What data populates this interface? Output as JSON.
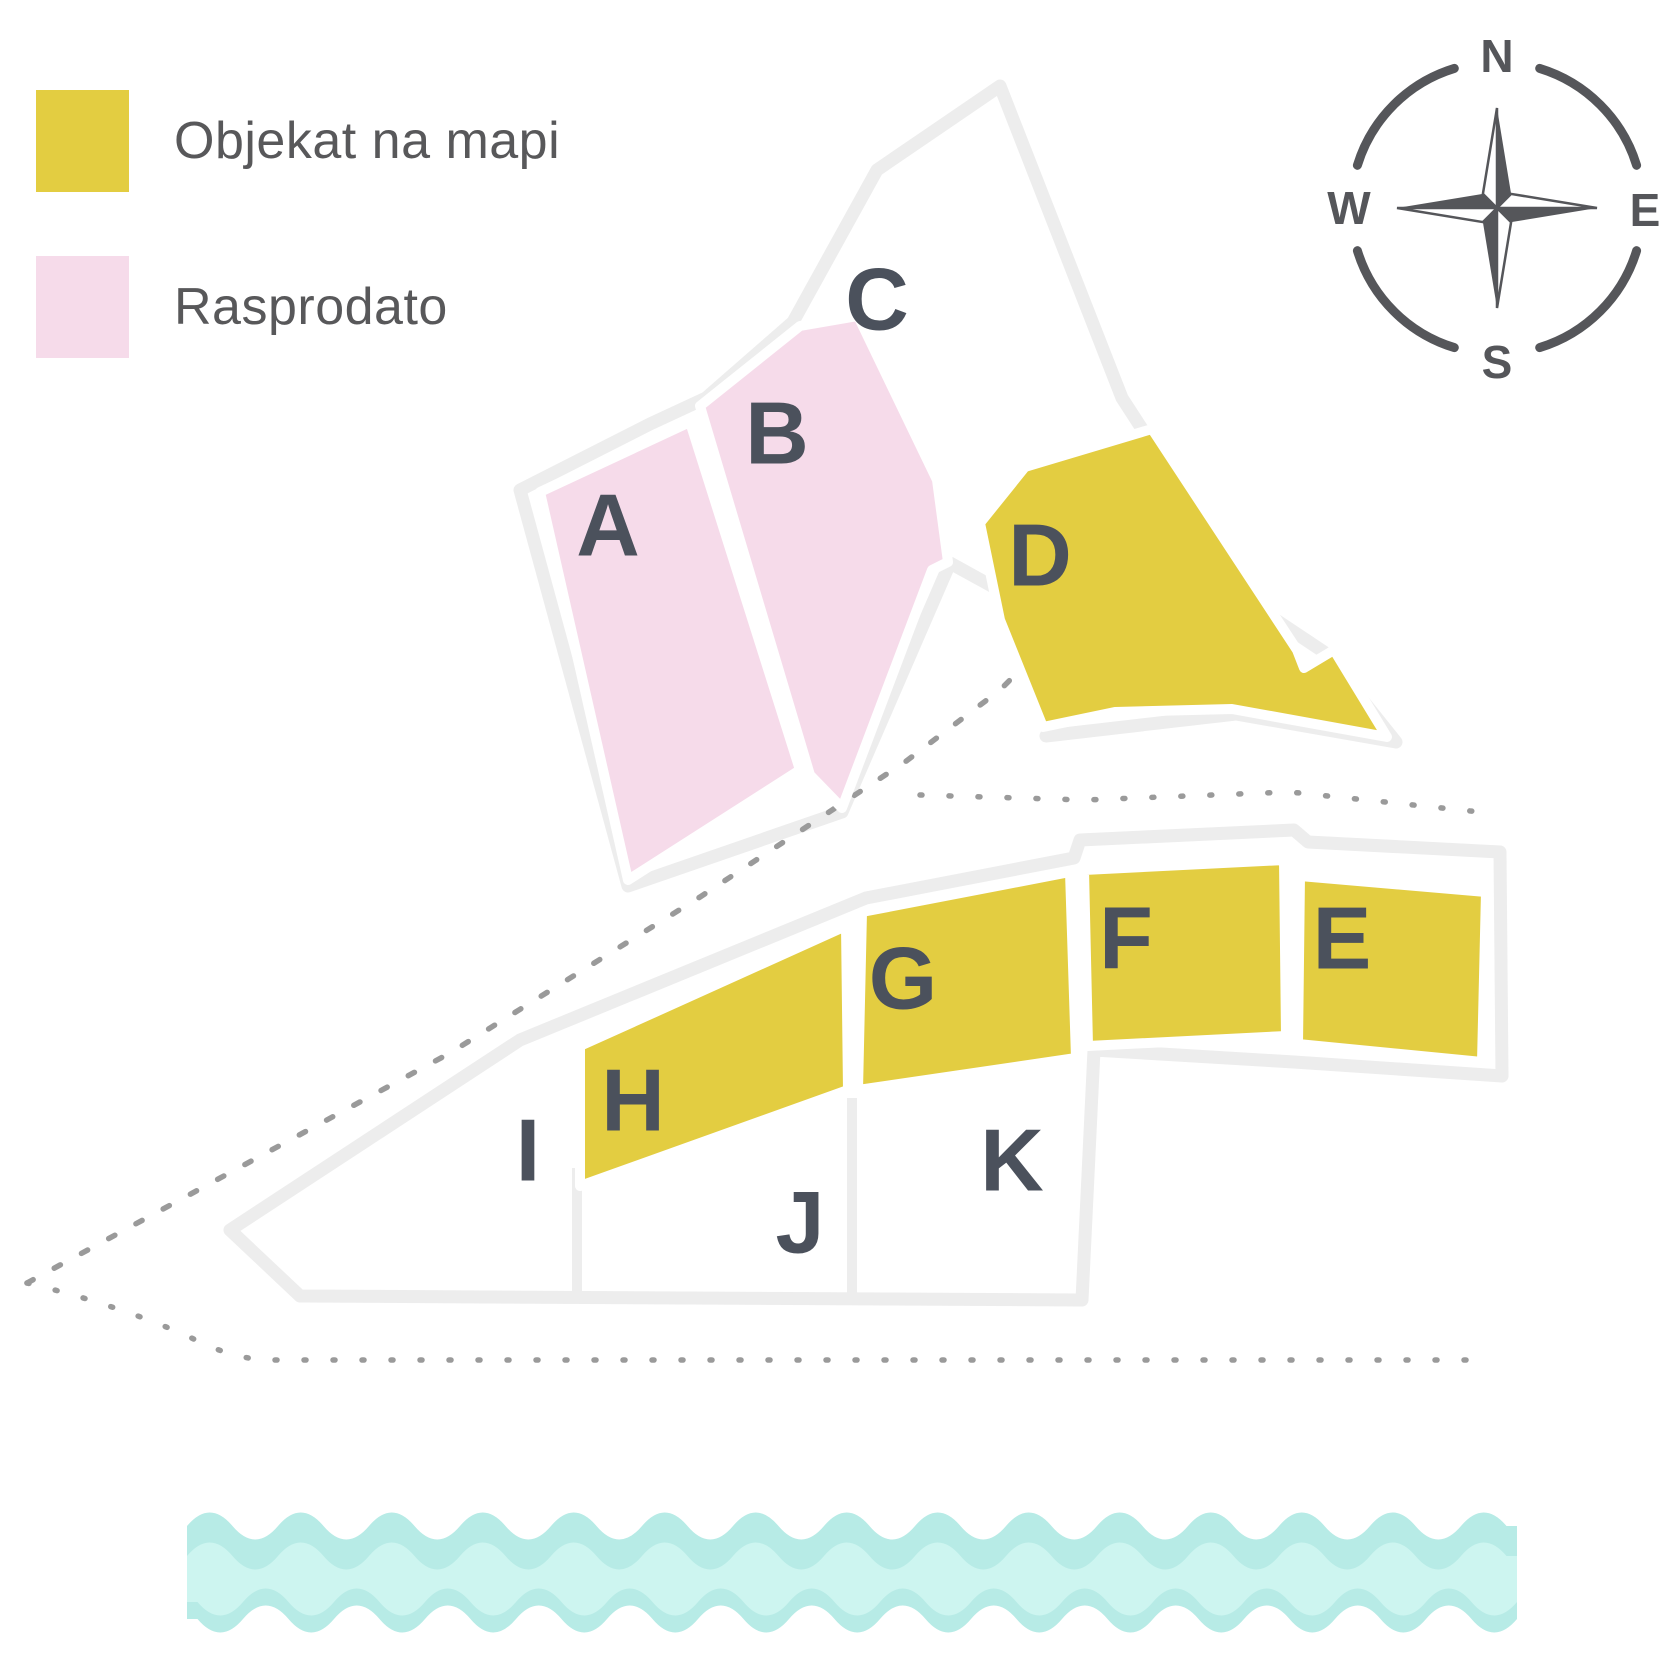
{
  "legend": {
    "items": [
      {
        "label": "Objekat na mapi",
        "status": "available",
        "color": "#e3cd41"
      },
      {
        "label": "Rasprodato",
        "status": "sold",
        "color": "#f6dbea"
      }
    ]
  },
  "zones": [
    {
      "label": "A",
      "status": "sold"
    },
    {
      "label": "B",
      "status": "sold"
    },
    {
      "label": "C",
      "status": "none"
    },
    {
      "label": "D",
      "status": "available"
    },
    {
      "label": "E",
      "status": "available"
    },
    {
      "label": "F",
      "status": "available"
    },
    {
      "label": "G",
      "status": "available"
    },
    {
      "label": "H",
      "status": "available"
    },
    {
      "label": "I",
      "status": "none"
    },
    {
      "label": "J",
      "status": "none"
    },
    {
      "label": "K",
      "status": "none"
    }
  ],
  "compass": {
    "n": "N",
    "e": "E",
    "s": "S",
    "w": "W"
  },
  "colors": {
    "available": "#e3cd41",
    "sold": "#f6dbea",
    "zone_white": "#ffffff",
    "outline": "#ededed",
    "zone_label": "#4b515c",
    "legend_text": "#58585a",
    "dots": "#9a9a9a",
    "wave": "#b7ebe6",
    "wave_light": "#cdf5f0",
    "compass": "#55565a"
  }
}
